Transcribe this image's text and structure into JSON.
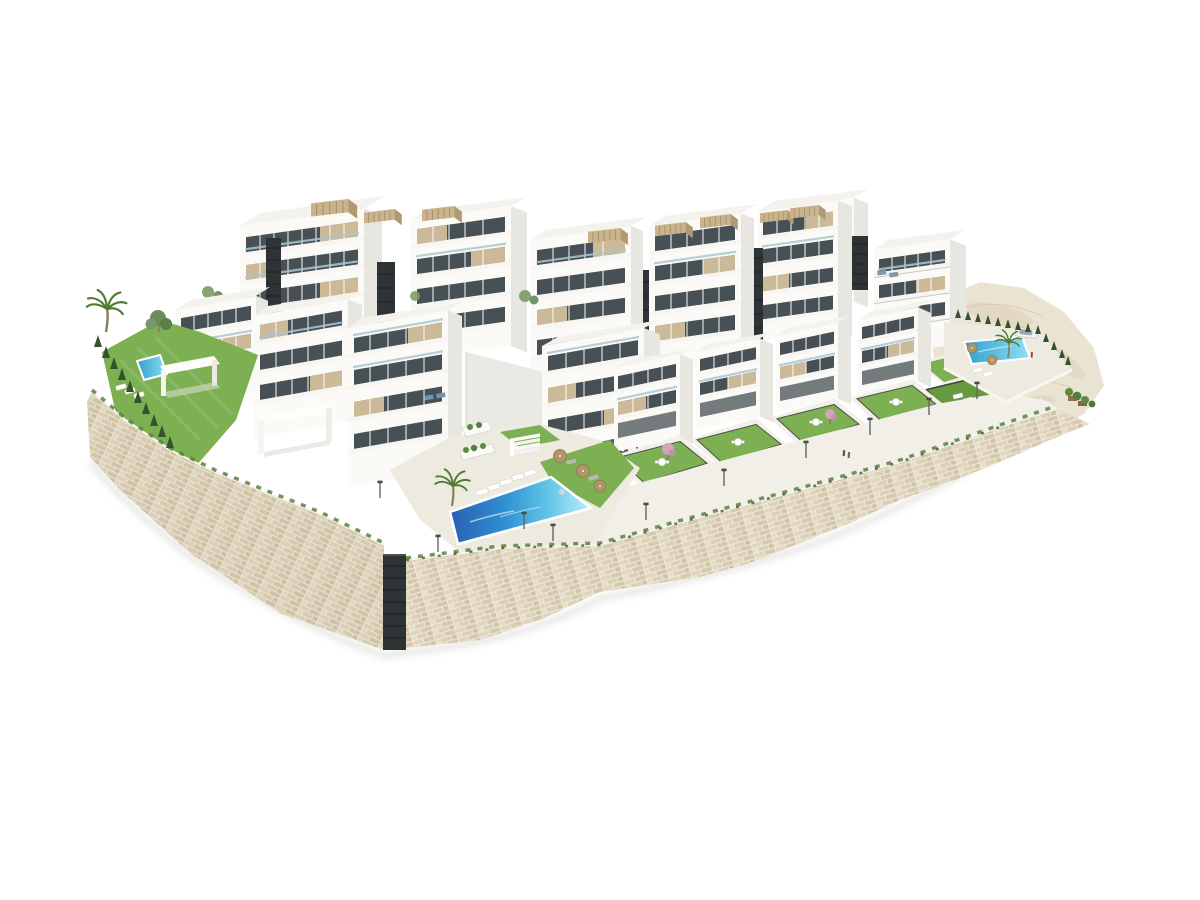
{
  "meta": {
    "type": "architectural-3d-render",
    "description": "Aerial 3D visualization of a terraced white residential complex on a hillside: apartment blocks with beige panels, dark stair cores and rooftop pergolas, private gardens with lawns, three swimming pools, palm trees, cypress hedges, a curved stone retaining wall around the lower perimeter and bare beige terrain at the upper right, on a plain white background."
  },
  "palette": {
    "page-bg": "#ffffff",
    "white-face": "#fbfaf7",
    "shade-face": "#e7e6e1",
    "roof": "#f3f2ed",
    "glass": "#475054",
    "glass-light": "#70828a",
    "beige": "#ccb997",
    "beige-dark": "#b3a07f",
    "core-dark": "#2e3335",
    "lawn": "#7cb052",
    "lawn-dark": "#669a3f",
    "hedge": "#35522c",
    "palm-green": "#4f7c33",
    "pool-deep": "#2a5fb4",
    "pool-mid": "#3f9fd6",
    "pool-light": "#7fd4ec",
    "pool-pale": "#c8eff8",
    "stone-mortar": "#efe8d9",
    "stone-dark": "#d2c5aa",
    "terrain": "#ebe3d1",
    "deck": "#edebe0",
    "walkway": "#f1efe7",
    "garden-wall": "#4c514b",
    "pergola-wood": "#c9b48e",
    "pink-tree": "#d3a3c0",
    "umbrella-tan": "#b29469",
    "car-white": "#f4f4f2",
    "shadow": "#d7d6d2"
  },
  "scene": {
    "buildings": {
      "back_blocks": 7,
      "mid_blocks": 4,
      "front_townhouses": 4,
      "stair_cores": 6,
      "roof_pergolas": 8,
      "parking_entrance": 1
    },
    "pools": [
      {
        "name": "main-community-pool",
        "location": "lower-center"
      },
      {
        "name": "left-garden-pool",
        "location": "left garden"
      },
      {
        "name": "right-community-pool",
        "location": "right deck"
      }
    ],
    "landscape": {
      "lawns": 9,
      "palm_trees": 3,
      "cypress_hedges": 2,
      "pink_flowering_trees": 2,
      "street_lamps": 10,
      "retaining_wall": "stone, wraps lower perimeter",
      "terrain": "unbuilt beige ground, upper right"
    },
    "objects": {
      "sun_loungers": 14,
      "parasols": 5,
      "garden_table_sets": 6,
      "cars": 1,
      "people": 3
    }
  }
}
